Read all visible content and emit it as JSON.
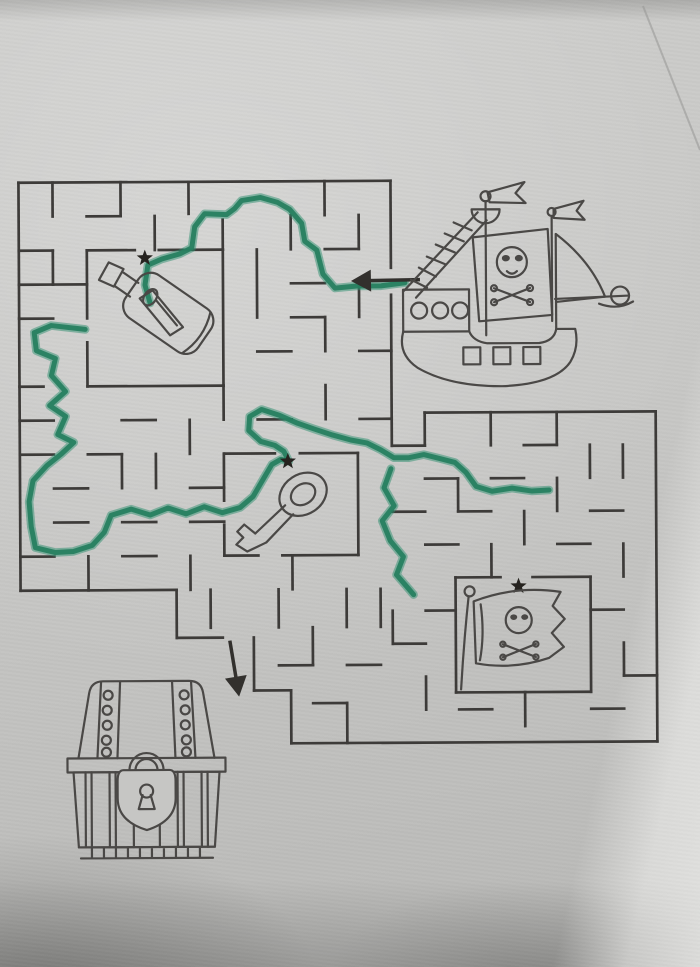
{
  "scene": {
    "title": "Pirate treasure maze worksheet, partially solved with a green marker",
    "paper_color": "#c6c6c4",
    "wall_color": "#3d3b39",
    "ink_color": "#4a4846",
    "marker_color": "#2e9070",
    "marker_dark": "#277f60",
    "star_color": "#26231f",
    "arrow_color": "#32302d"
  },
  "items": [
    {
      "id": "pirate-ship",
      "label": "pirate ship with skull sail",
      "cx": 515,
      "cy": 285
    },
    {
      "id": "message-bottle",
      "label": "message in a bottle",
      "cx": 155,
      "cy": 312
    },
    {
      "id": "key",
      "label": "old key",
      "cx": 280,
      "cy": 510
    },
    {
      "id": "pirate-flag",
      "label": "jolly roger flag",
      "cx": 518,
      "cy": 630
    },
    {
      "id": "treasure-chest",
      "label": "locked treasure chest",
      "cx": 145,
      "cy": 768
    }
  ],
  "stars": [
    {
      "x": 146,
      "y": 257
    },
    {
      "x": 288,
      "y": 461
    },
    {
      "x": 518,
      "y": 587
    }
  ],
  "arrows": {
    "entry": {
      "from": [
        421,
        280
      ],
      "to": [
        352,
        281
      ]
    },
    "exit": {
      "from": [
        229,
        640
      ],
      "to": [
        238,
        696
      ]
    }
  },
  "maze": {
    "outline": [
      [
        20,
        181,
        392,
        181
      ],
      [
        20,
        181,
        20,
        589
      ],
      [
        20,
        589,
        176,
        589
      ],
      [
        176,
        589,
        176,
        637
      ],
      [
        176,
        637,
        222,
        637
      ],
      [
        253,
        637,
        253,
        690
      ],
      [
        253,
        690,
        290,
        690
      ],
      [
        290,
        690,
        290,
        743
      ],
      [
        290,
        743,
        656,
        743
      ],
      [
        656,
        413,
        656,
        743
      ],
      [
        425,
        413,
        656,
        413
      ],
      [
        425,
        413,
        425,
        446
      ],
      [
        392,
        446,
        425,
        446
      ],
      [
        392,
        181,
        392,
        268
      ],
      [
        392,
        295,
        392,
        446
      ]
    ],
    "rooms": [
      [
        88,
        249,
        136,
        249
      ],
      [
        160,
        249,
        224,
        249
      ],
      [
        88,
        249,
        88,
        317
      ],
      [
        88,
        341,
        88,
        385
      ],
      [
        224,
        249,
        224,
        385
      ],
      [
        88,
        385,
        224,
        385
      ],
      [
        224,
        453,
        275,
        453
      ],
      [
        300,
        453,
        358,
        453
      ],
      [
        224,
        453,
        224,
        500
      ],
      [
        224,
        524,
        224,
        555
      ],
      [
        358,
        453,
        358,
        555
      ],
      [
        224,
        555,
        258,
        555
      ],
      [
        282,
        555,
        358,
        555
      ],
      [
        455,
        578,
        500,
        578
      ],
      [
        532,
        578,
        590,
        578
      ],
      [
        455,
        578,
        455,
        693
      ],
      [
        590,
        578,
        590,
        693
      ],
      [
        455,
        693,
        590,
        693
      ]
    ],
    "walls": [
      [
        54,
        181,
        54,
        215
      ],
      [
        122,
        181,
        122,
        215
      ],
      [
        190,
        181,
        190,
        213
      ],
      [
        326,
        181,
        326,
        215
      ],
      [
        88,
        215,
        122,
        215
      ],
      [
        156,
        215,
        156,
        249
      ],
      [
        224,
        219,
        224,
        249
      ],
      [
        292,
        215,
        292,
        249
      ],
      [
        360,
        215,
        360,
        249
      ],
      [
        20,
        249,
        54,
        249
      ],
      [
        326,
        249,
        360,
        249
      ],
      [
        54,
        249,
        54,
        283
      ],
      [
        20,
        283,
        54,
        283
      ],
      [
        54,
        283,
        88,
        283
      ],
      [
        258,
        249,
        258,
        317
      ],
      [
        292,
        283,
        326,
        283
      ],
      [
        360,
        283,
        360,
        317
      ],
      [
        20,
        317,
        54,
        317
      ],
      [
        292,
        317,
        326,
        317
      ],
      [
        326,
        317,
        326,
        351
      ],
      [
        360,
        351,
        392,
        351
      ],
      [
        258,
        351,
        292,
        351
      ],
      [
        20,
        385,
        44,
        385
      ],
      [
        224,
        385,
        224,
        419
      ],
      [
        258,
        419,
        292,
        419
      ],
      [
        326,
        385,
        326,
        419
      ],
      [
        360,
        419,
        392,
        419
      ],
      [
        20,
        419,
        54,
        419
      ],
      [
        122,
        419,
        156,
        419
      ],
      [
        190,
        419,
        190,
        453
      ],
      [
        20,
        453,
        54,
        453
      ],
      [
        88,
        453,
        122,
        453
      ],
      [
        122,
        453,
        122,
        487
      ],
      [
        156,
        453,
        156,
        487
      ],
      [
        190,
        487,
        224,
        487
      ],
      [
        54,
        487,
        88,
        487
      ],
      [
        54,
        521,
        88,
        521
      ],
      [
        122,
        521,
        156,
        521
      ],
      [
        190,
        521,
        224,
        521
      ],
      [
        20,
        555,
        54,
        555
      ],
      [
        88,
        555,
        88,
        589
      ],
      [
        122,
        555,
        156,
        555
      ],
      [
        190,
        555,
        190,
        589
      ],
      [
        292,
        555,
        292,
        589
      ],
      [
        491,
        413,
        491,
        446
      ],
      [
        557,
        413,
        557,
        446
      ],
      [
        524,
        446,
        557,
        446
      ],
      [
        590,
        446,
        590,
        479
      ],
      [
        623,
        446,
        623,
        479
      ],
      [
        425,
        479,
        458,
        479
      ],
      [
        491,
        479,
        524,
        479
      ],
      [
        557,
        479,
        557,
        512
      ],
      [
        458,
        479,
        458,
        512
      ],
      [
        392,
        512,
        425,
        512
      ],
      [
        458,
        512,
        491,
        512
      ],
      [
        590,
        512,
        623,
        512
      ],
      [
        524,
        512,
        524,
        545
      ],
      [
        425,
        545,
        458,
        545
      ],
      [
        491,
        545,
        491,
        578
      ],
      [
        557,
        545,
        590,
        545
      ],
      [
        623,
        545,
        623,
        578
      ],
      [
        425,
        611,
        455,
        611
      ],
      [
        392,
        611,
        392,
        644
      ],
      [
        392,
        644,
        425,
        644
      ],
      [
        425,
        677,
        425,
        710
      ],
      [
        458,
        710,
        491,
        710
      ],
      [
        524,
        693,
        524,
        727
      ],
      [
        590,
        611,
        623,
        611
      ],
      [
        623,
        644,
        623,
        677
      ],
      [
        590,
        710,
        623,
        710
      ],
      [
        623,
        677,
        656,
        677
      ],
      [
        210,
        589,
        210,
        627
      ],
      [
        278,
        589,
        278,
        627
      ],
      [
        312,
        627,
        312,
        665
      ],
      [
        346,
        589,
        346,
        627
      ],
      [
        278,
        665,
        312,
        665
      ],
      [
        346,
        665,
        380,
        665
      ],
      [
        312,
        703,
        346,
        703
      ],
      [
        346,
        703,
        346,
        743
      ],
      [
        380,
        589,
        380,
        627
      ]
    ]
  },
  "solution": {
    "subpaths": [
      [
        [
          406,
          283
        ],
        [
          382,
          286
        ],
        [
          358,
          286
        ],
        [
          336,
          288
        ],
        [
          324,
          274
        ],
        [
          318,
          250
        ],
        [
          306,
          241
        ],
        [
          303,
          223
        ],
        [
          291,
          209
        ],
        [
          279,
          202
        ],
        [
          262,
          197
        ],
        [
          243,
          200
        ],
        [
          236,
          208
        ],
        [
          228,
          214
        ],
        [
          206,
          213
        ],
        [
          196,
          226
        ],
        [
          193,
          247
        ],
        [
          181,
          253
        ],
        [
          163,
          258
        ],
        [
          149,
          264
        ],
        [
          146,
          284
        ],
        [
          151,
          302
        ]
      ],
      [
        [
          86,
          328
        ],
        [
          52,
          324
        ],
        [
          35,
          331
        ],
        [
          37,
          349
        ],
        [
          56,
          357
        ],
        [
          52,
          374
        ],
        [
          66,
          390
        ],
        [
          50,
          404
        ],
        [
          66,
          415
        ],
        [
          58,
          433
        ],
        [
          74,
          441
        ],
        [
          62,
          452
        ],
        [
          47,
          464
        ],
        [
          33,
          479
        ],
        [
          29,
          500
        ],
        [
          31,
          525
        ],
        [
          35,
          546
        ],
        [
          55,
          551
        ],
        [
          73,
          550
        ],
        [
          92,
          544
        ],
        [
          104,
          531
        ],
        [
          111,
          514
        ],
        [
          131,
          508
        ],
        [
          150,
          514
        ],
        [
          168,
          507
        ],
        [
          186,
          513
        ],
        [
          204,
          506
        ],
        [
          222,
          512
        ],
        [
          240,
          507
        ],
        [
          253,
          496
        ],
        [
          263,
          479
        ],
        [
          272,
          464
        ],
        [
          281,
          459
        ],
        [
          289,
          461
        ],
        [
          284,
          451
        ],
        [
          275,
          445
        ],
        [
          261,
          441
        ],
        [
          249,
          430
        ],
        [
          250,
          416
        ],
        [
          262,
          409
        ],
        [
          280,
          415
        ],
        [
          298,
          423
        ],
        [
          315,
          429
        ],
        [
          333,
          435
        ],
        [
          351,
          440
        ],
        [
          367,
          443
        ],
        [
          381,
          450
        ],
        [
          394,
          458
        ],
        [
          409,
          458
        ],
        [
          424,
          455
        ],
        [
          440,
          459
        ],
        [
          455,
          463
        ],
        [
          466,
          473
        ],
        [
          476,
          487
        ],
        [
          492,
          492
        ],
        [
          512,
          489
        ],
        [
          532,
          492
        ],
        [
          549,
          491
        ]
      ],
      [
        [
          391,
          469
        ],
        [
          384,
          488
        ],
        [
          394,
          506
        ],
        [
          382,
          521
        ],
        [
          390,
          541
        ],
        [
          403,
          557
        ],
        [
          396,
          575
        ],
        [
          408,
          589
        ],
        [
          413,
          595
        ]
      ]
    ]
  }
}
